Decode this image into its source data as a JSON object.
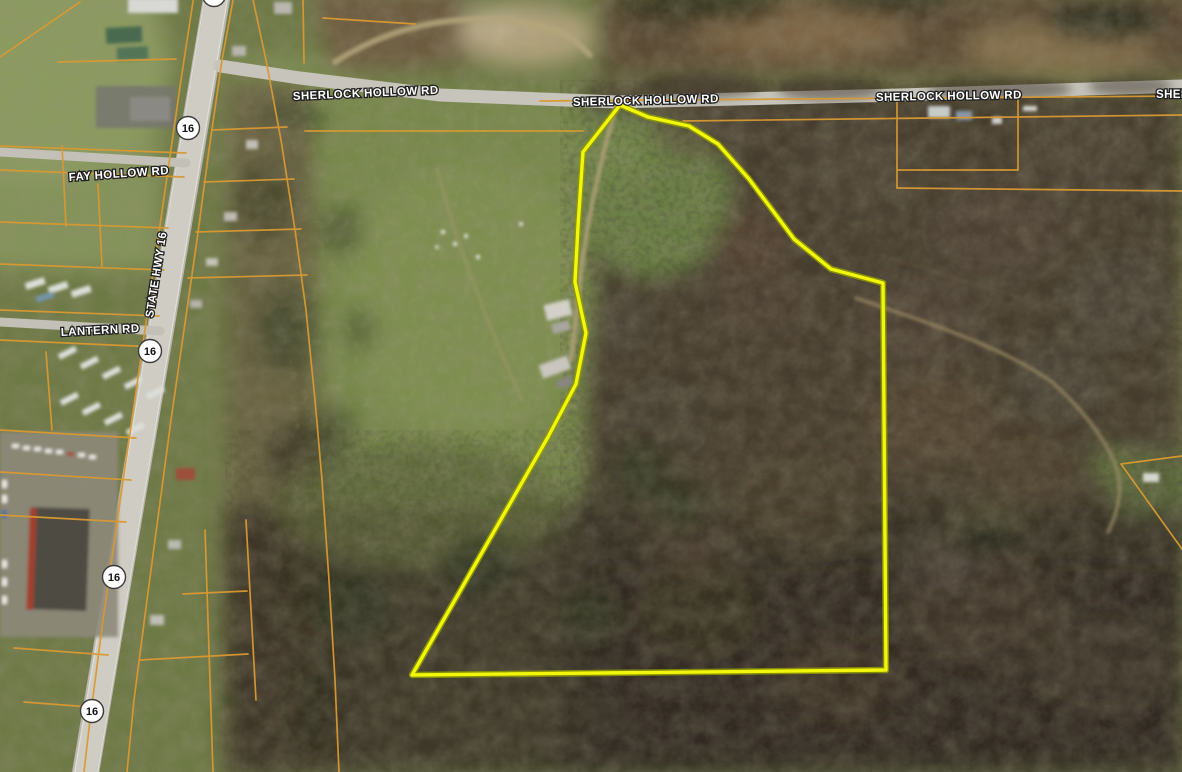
{
  "map": {
    "description": "aerial imagery parcel map viewer",
    "road_labels": [
      {
        "text": "SHERLOCK HOLLOW RD"
      },
      {
        "text": "SHERLOCK HOLLOW RD"
      },
      {
        "text": "SHERLOCK HOLLOW RD"
      },
      {
        "text": "SHERLOCK HOLLOW RD"
      },
      {
        "text": "FAY HOLLOW RD"
      },
      {
        "text": "LANTERN RD"
      },
      {
        "text": "STATE HWY 16"
      }
    ],
    "route_shields": [
      {
        "label": "16"
      },
      {
        "label": "16"
      },
      {
        "label": "16"
      },
      {
        "label": "16"
      },
      {
        "label": "16"
      }
    ],
    "highlight_parcel": {
      "points": "620,105 648,117 689,126 718,144 749,179 794,239 831,269 883,283 886,670 412,675 548,437 576,384 586,333 575,282 578,226 583,152",
      "stroke": "#f2f60a"
    },
    "colors": {
      "parcel_line": "#d99933",
      "label_fill": "#ffffff",
      "label_outline": "#1f1f1f",
      "shield_fill": "#ffffff",
      "shield_text": "#111111"
    }
  }
}
